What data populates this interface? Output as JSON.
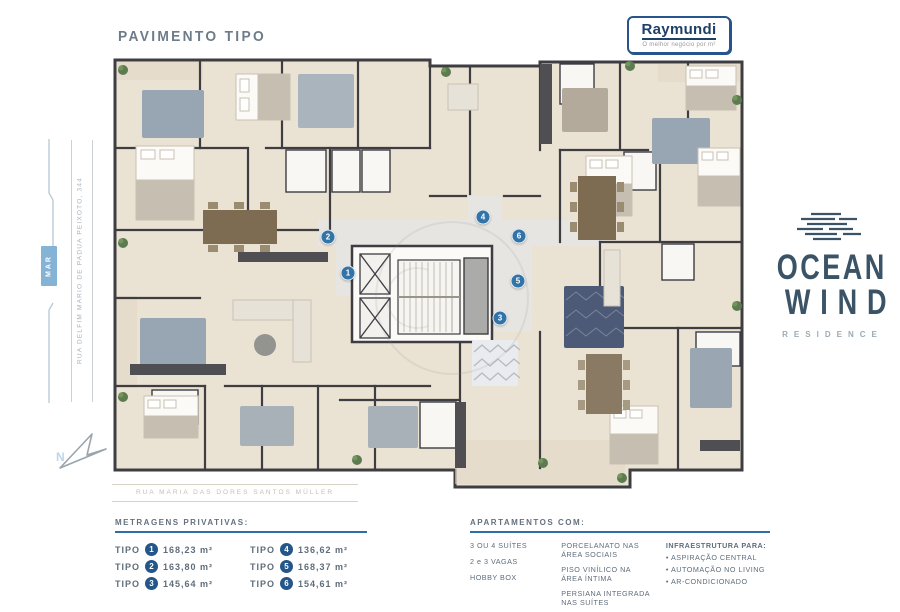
{
  "title": "PAVIMENTO TIPO",
  "brand": {
    "name": "Raymundi",
    "tagline": "O melhor negócio por m²"
  },
  "building": {
    "name_line1": "OCEAN",
    "name_line2": "WIND",
    "subtitle": "RESIDENCE"
  },
  "map": {
    "sea_badge": "MAR",
    "north": "N",
    "street_left": "RUA DELFIM MARIO DE PADUA PEIXOTO, 344",
    "street_bottom": "RUA MARIA DAS DORES SANTOS MÜLLER"
  },
  "plan": {
    "markers": [
      "1",
      "2",
      "3",
      "4",
      "5",
      "6"
    ]
  },
  "metragens": {
    "title": "METRAGENS PRIVATIVAS:",
    "unit_label": "TIPO",
    "items": [
      {
        "n": "1",
        "area": "168,23 m²"
      },
      {
        "n": "2",
        "area": "163,80 m²"
      },
      {
        "n": "3",
        "area": "145,64 m²"
      },
      {
        "n": "4",
        "area": "136,62 m²"
      },
      {
        "n": "5",
        "area": "168,37 m²"
      },
      {
        "n": "6",
        "area": "154,61 m²"
      }
    ]
  },
  "apartamentos": {
    "title": "APARTAMENTOS COM:",
    "features_col1": [
      "3 OU 4 SUÍTES",
      "2 e 3 VAGAS",
      "HOBBY BOX"
    ],
    "features_col2": [
      "PORCELANATO NAS ÁREA SOCIAIS",
      "PISO VINÍLICO NA ÁREA ÍNTIMA",
      "PERSIANA INTEGRADA NAS SUÍTES"
    ],
    "infra_title": "INFRAESTRUTURA PARA:",
    "infra_items": [
      "• ASPIRAÇÃO CENTRAL",
      "• AUTOMAÇÃO NO LIVING",
      "• AR-CONDICIONADO"
    ]
  },
  "colors": {
    "accent_blue": "#2e6da6",
    "marker_blue": "#3273a8",
    "logo_navy": "#3a5366",
    "brand_navy": "#1e4168",
    "plan_floor": "#eae2d3",
    "plan_wall": "#3d3d42"
  }
}
